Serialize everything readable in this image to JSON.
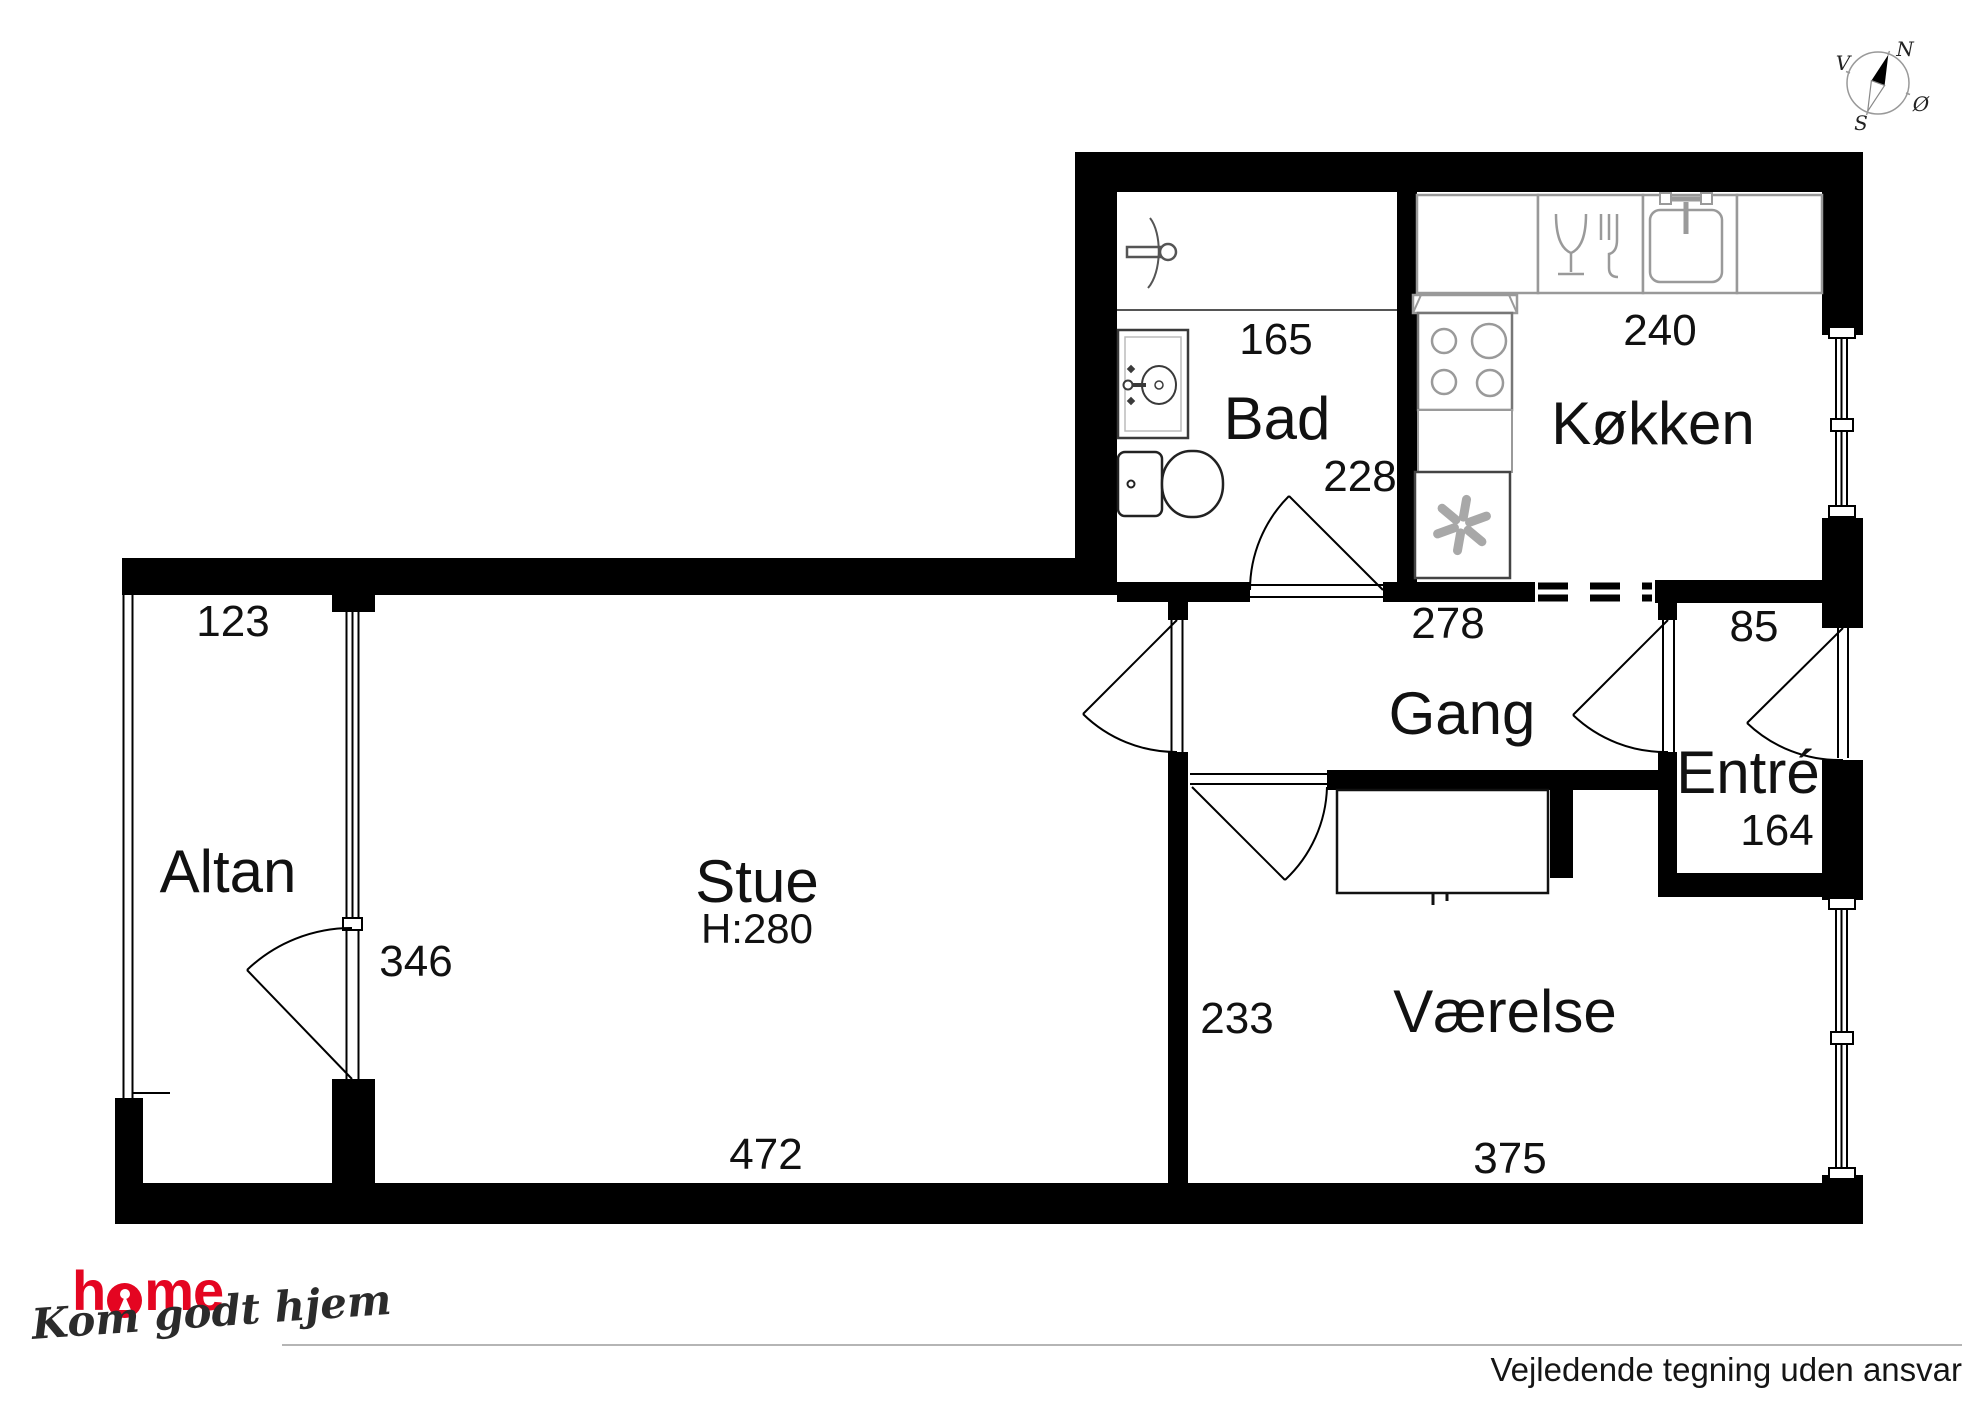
{
  "compass": {
    "north": "N",
    "east": "Ø",
    "south": "S",
    "west": "V"
  },
  "rooms": {
    "altan": "Altan",
    "stue": "Stue",
    "stue_ceiling_height": "H:280",
    "bad": "Bad",
    "kokken": "Køkken",
    "gang": "Gang",
    "entre": "Entré",
    "vaerelse": "Værelse"
  },
  "dimensions": {
    "altan_width": "123",
    "altan_length": "346",
    "stue_width": "472",
    "bad_width": "165",
    "bad_depth": "228",
    "kokken_width": "240",
    "gang_width": "278",
    "entre_passage": "85",
    "entre_depth": "164",
    "vaerelse_depth": "233",
    "vaerelse_width": "375"
  },
  "icons": {
    "compass": "compass-rose-icon",
    "shower": "shower-icon",
    "bath_sink": "washbasin-icon",
    "toilet": "toilet-icon",
    "dishwasher": "dishwasher-icon",
    "kitchen_sink": "kitchen-sink-icon",
    "stove": "stove-burners-icon",
    "fridge": "refrigerator-fan-icon",
    "keyhole": "keyhole-o-icon"
  },
  "footer": {
    "logo_part1": "h",
    "logo_part2": "me",
    "tagline": "Kom godt hjem",
    "disclaimer": "Vejledende tegning uden ansvar"
  },
  "colors": {
    "wall": "#000000",
    "fixture_gray": "#999999",
    "brand_red": "#e40521"
  }
}
